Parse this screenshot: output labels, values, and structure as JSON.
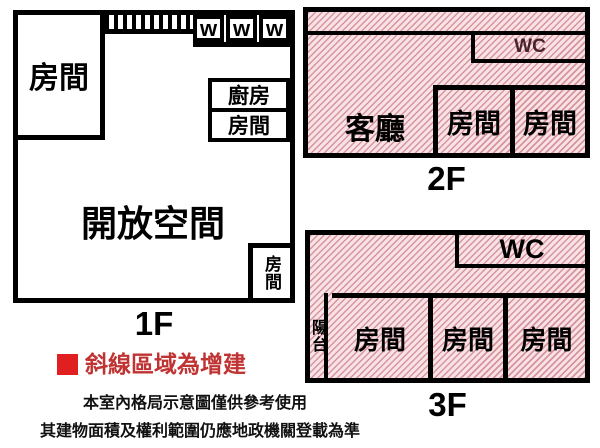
{
  "colors": {
    "wall": "#000000",
    "hatch_background": "#f8e2e5",
    "hatch_line": "#ba5460",
    "legend_marker_red": "#e02020",
    "legend_text_red": "#c03333"
  },
  "f1": {
    "label": "1F",
    "bedroom_topleft": "房間",
    "kitchen": "廚房",
    "bedroom_right": "房間",
    "open_space": "開放空間",
    "bedroom_corner": "房間",
    "w1": "w",
    "w2": "w",
    "w3": "w"
  },
  "f2": {
    "label": "2F",
    "living_room": "客廳",
    "bedroom1": "房間",
    "bedroom2": "房間",
    "wc": "WC"
  },
  "f3": {
    "label": "3F",
    "wc": "WC",
    "balcony": "陽台",
    "bedroom1": "房間",
    "bedroom2": "房間",
    "bedroom3": "房間"
  },
  "legend": {
    "text": "斜線區域為增建"
  },
  "notes": {
    "line1": "本室內格局示意圖僅供參考使用",
    "line2": "其建物面積及權利範圍仍應地政機關登載為準"
  }
}
